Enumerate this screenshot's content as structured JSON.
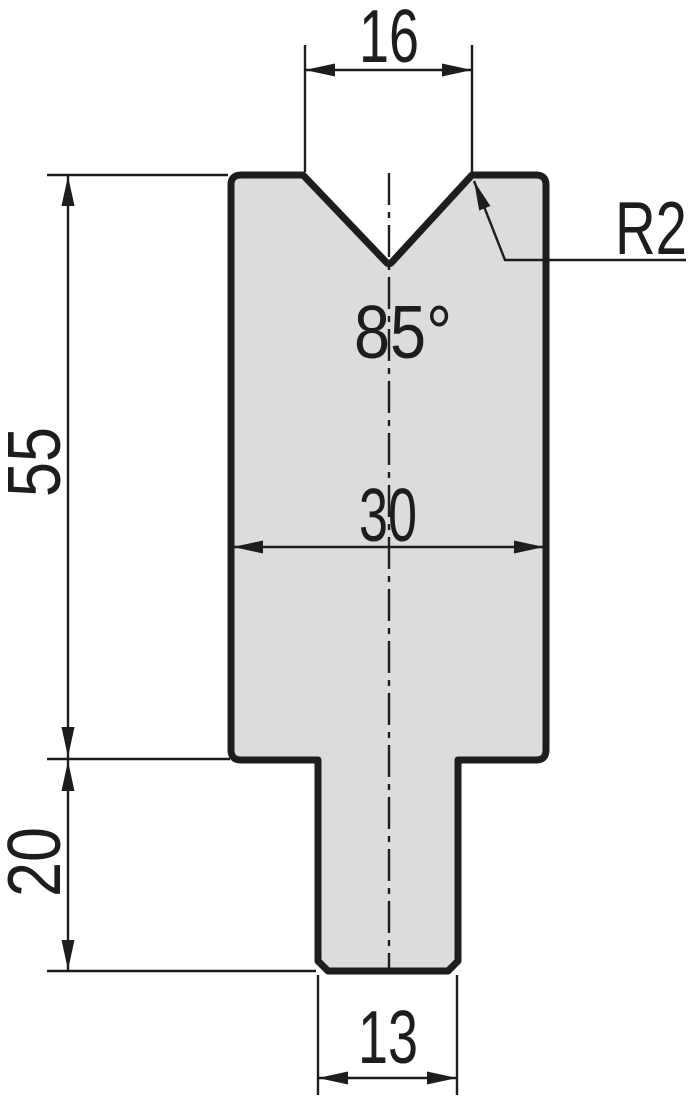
{
  "drawing": {
    "type": "technical-dimension-drawing",
    "subject": "press-brake V-die cross-section",
    "labels": {
      "vee_opening_width": "16",
      "vee_angle": "85°",
      "vee_radius": "R2",
      "body_width": "30",
      "body_height": "55",
      "tang_height": "20",
      "tang_width": "13"
    },
    "colors": {
      "background": "#ffffff",
      "part_fill": "#dcdcdc",
      "line": "#1d1d1b"
    }
  }
}
